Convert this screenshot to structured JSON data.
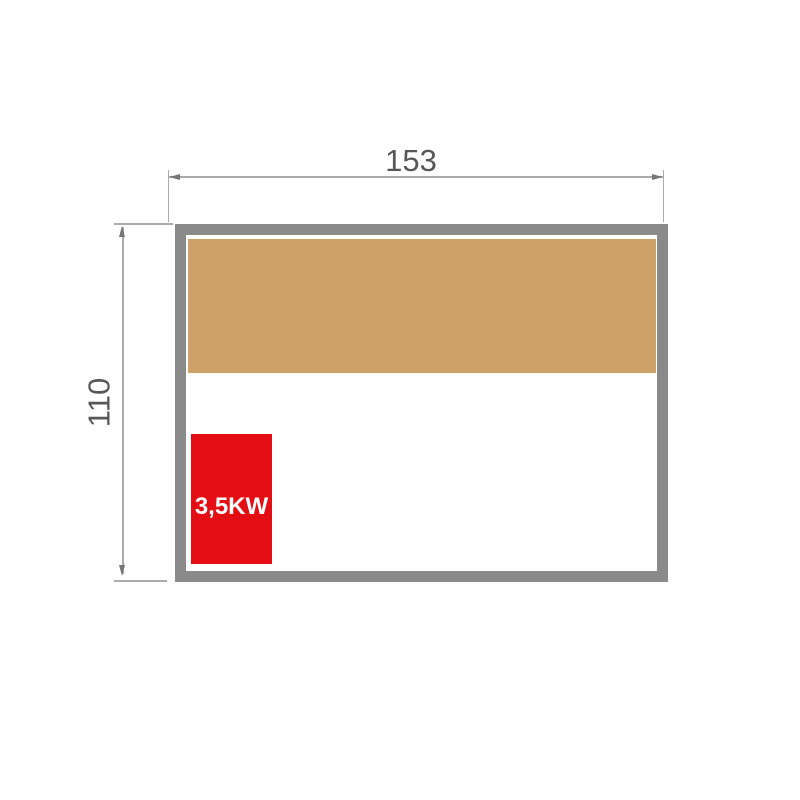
{
  "diagram": {
    "type": "floor-plan-dimension-drawing",
    "dimensions": {
      "width": {
        "label": "153"
      },
      "height": {
        "label": "110"
      }
    },
    "heater": {
      "power_label": "3,5KW"
    }
  },
  "colors": {
    "wall": "#8A8A8A",
    "bench": "#CDA167",
    "heater": "#E30D13",
    "heater_text": "#FFFFFF",
    "dim_line": "#ABABAB",
    "dim_arrow": "#757575",
    "dim_text": "#575757",
    "background": "#FFFFFF"
  }
}
